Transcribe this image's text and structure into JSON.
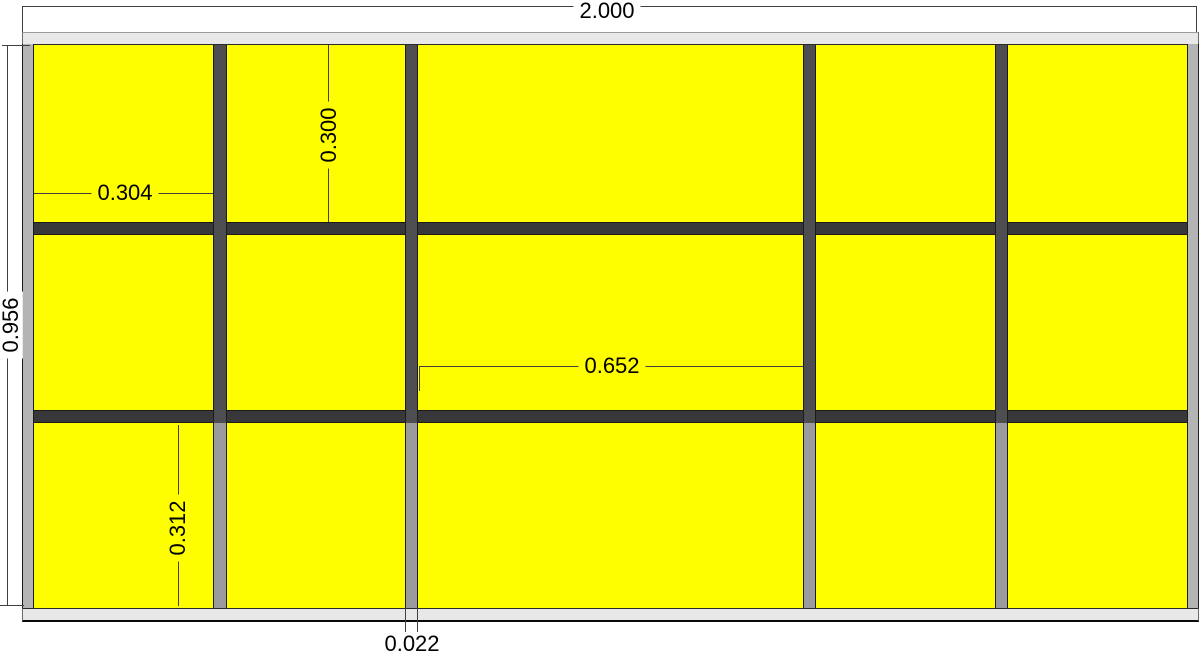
{
  "drawing": {
    "dim_labels": {
      "overall_width": "2.000",
      "overall_height": "0.956",
      "first_cell_width": "0.304",
      "top_row_height": "0.300",
      "center_cell_width": "0.652",
      "bottom_row_height": "0.312",
      "bottom_divider_width": "0.022"
    },
    "colors": {
      "panel_fill": "#FEFE00",
      "rail_dark": "#38383A",
      "mullion_dark": "#4E4E52",
      "mullion_gray": "#9B9B9D",
      "stile_gray": "#B4B4B4",
      "cap_gray": "#E8E8E8",
      "outline": "#1C1C1C",
      "dim_line": "#3F3F3F",
      "dim_text": "#000000",
      "background": "#FFFFFF"
    }
  }
}
